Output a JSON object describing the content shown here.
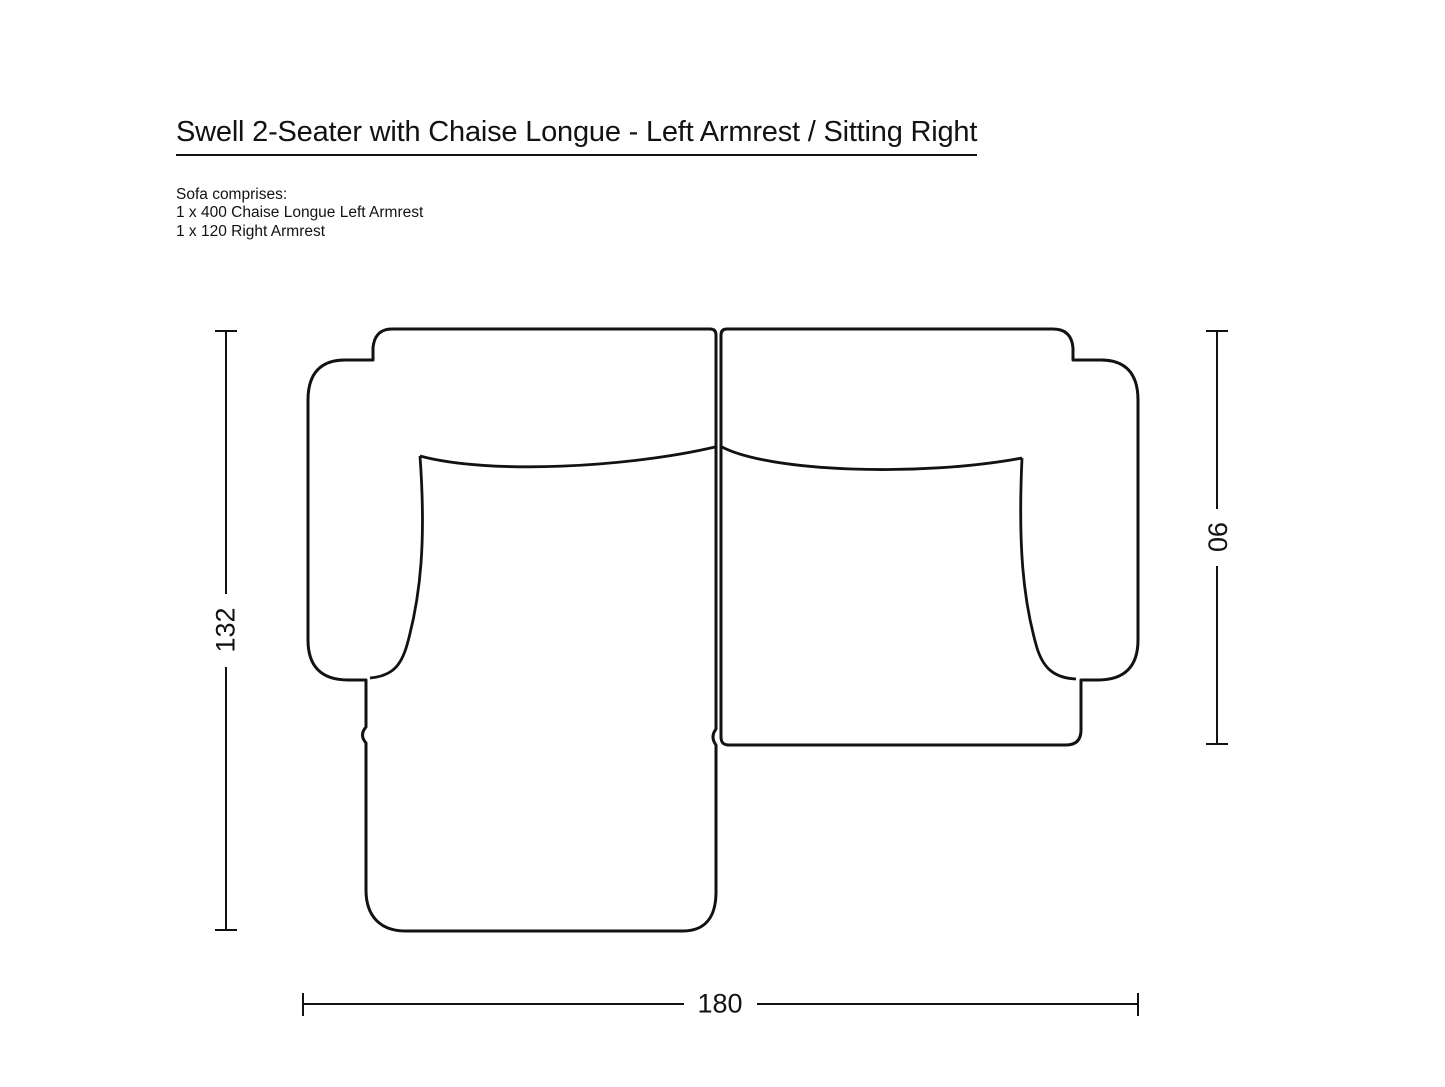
{
  "page": {
    "background_color": "#ffffff",
    "line_color": "#121212"
  },
  "header": {
    "title": "Swell 2-Seater with Chaise Longue - Left Armrest / Sitting Right"
  },
  "composition": {
    "heading": "Sofa comprises:",
    "lines": [
      "1 x 400 Chaise Longue Left Armrest",
      "1 x 120 Right Armrest"
    ]
  },
  "diagram": {
    "view": "sofa-top-view-line-drawing",
    "dimensions": {
      "total_depth": "132",
      "seat_depth": "90",
      "total_width": "180"
    }
  }
}
